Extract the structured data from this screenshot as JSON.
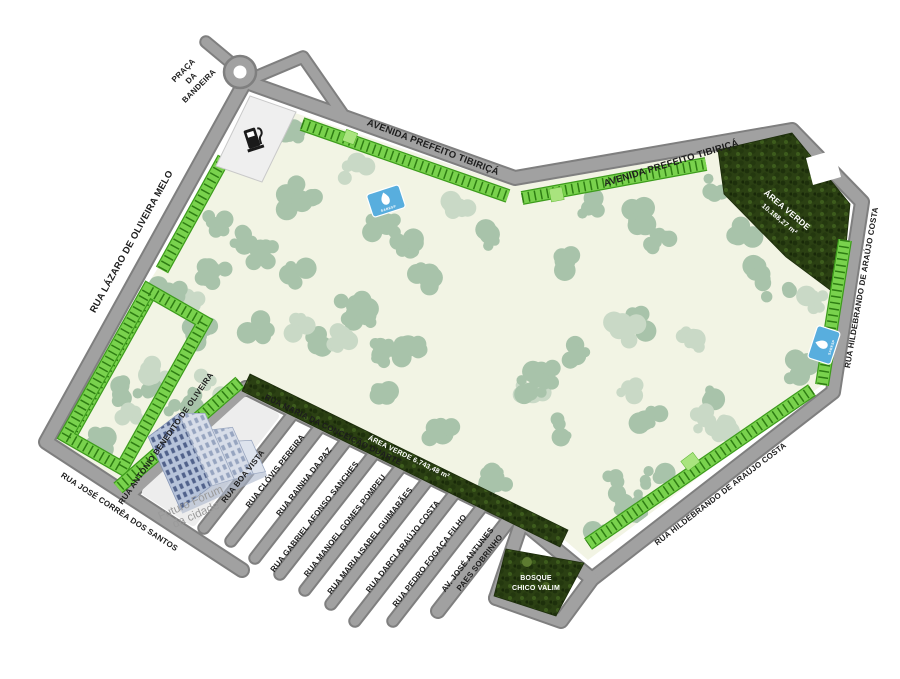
{
  "palette": {
    "park_fill": "#f2f4e4",
    "tree": "#a8c3aa",
    "tree_light": "#c9d9c6",
    "parking": "#79d24d",
    "parking_dark": "#2e7d13",
    "road": "#a1a1a1",
    "road_edge": "#7f7f7f",
    "forest": "#2b4013",
    "marker_blue": "#58aede",
    "parcel": "#ededed"
  },
  "map": {
    "plaza": {
      "lines": [
        "PRAÇA",
        "DA",
        "BANDEIRA"
      ]
    },
    "streets": {
      "avenida": "AVENIDA PREFEITO TIBIRIÇÁ",
      "lazaro": "RUA LÁZARO DE OLIVEIRA MELO",
      "hildebrando": "RUA HILDEBRANDO DE ARAÚJO COSTA",
      "jose_correa": "RUA JOSÉ CORRÊA DOS SANTOS",
      "antonio_benedito": "RUA ANTÔNIO BENEDITO DE OLIVEIRA",
      "boa_vista": "RUA BOA VISTA",
      "maria_conceicao": "RUA MARIA DA CONCEIÇÃO DUARTE",
      "clovis": "RUA CLÓVIS PEREIRA",
      "rainha": "RUA RAINHA DA PAZ",
      "gabriel": "RUA GABRIEL AFONSO SANCHES",
      "manoel": "RUA MANOEL GOMES POMPEU",
      "maria_isabel": "RUA MARIA ISABEL GUIMARÃES",
      "darci": "RUA DARCI ARAÚJO COSTA",
      "pedro": "RUA PEDRO FOGAÇA FILHO",
      "jose_antunes_line1": "AV. JOSÉ ANTUNES",
      "jose_antunes_line2": "PAES SOBRINHO"
    },
    "areas": {
      "area_verde_1_line1": "ÁREA VERDE",
      "area_verde_1_line2": "10.188,27 m²",
      "area_verde_2": "ÁREA VERDE 6.743,48 m²",
      "bosque_line1": "BOSQUE",
      "bosque_line2": "CHICO VALIM"
    },
    "landmarks": {
      "forum_line1": "Futuro Fórum",
      "forum_line2": "da cidade",
      "sabesp": "SABESP"
    }
  }
}
